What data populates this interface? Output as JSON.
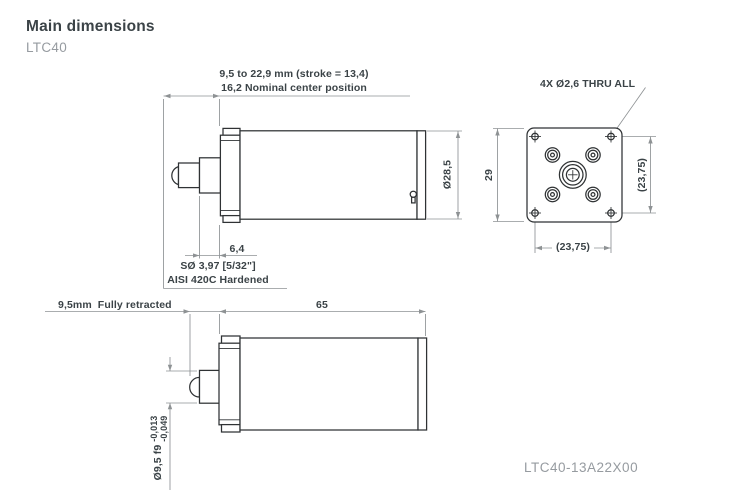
{
  "page": {
    "title": "Main dimensions",
    "model": "LTC40",
    "part_number": "LTC40-13A22X00"
  },
  "views": {
    "extended_side_view": {
      "stroke_range_label": "9,5 to 22,9 mm (stroke = 13,4)",
      "nominal_center_label": "16,2 Nominal center position",
      "body_diameter_label": "Ø28,5",
      "collar_width_label": "6,4",
      "tip_sphere_label": "SØ 3,97 [5/32\"]",
      "tip_material_label": "AISI 420C Hardened"
    },
    "front_view": {
      "mounting_holes_label": "4X Ø2,6 THRU ALL",
      "flange_size_label": "29",
      "hole_spacing_vertical_label": "(23,75)",
      "hole_spacing_horizontal_label": "(23,75)"
    },
    "retracted_side_view": {
      "retracted_label": "9,5mm  Fully retracted",
      "body_length_label": "65",
      "shaft_diameter_label": "Ø9,5 f9",
      "shaft_tolerance_upper": "-0,013",
      "shaft_tolerance_lower": "-0,049"
    }
  },
  "colors": {
    "line": "#2f3234",
    "dimension": "#8e9294",
    "text": "#3b4347",
    "muted_text": "#969ba0",
    "background": "#ffffff"
  }
}
